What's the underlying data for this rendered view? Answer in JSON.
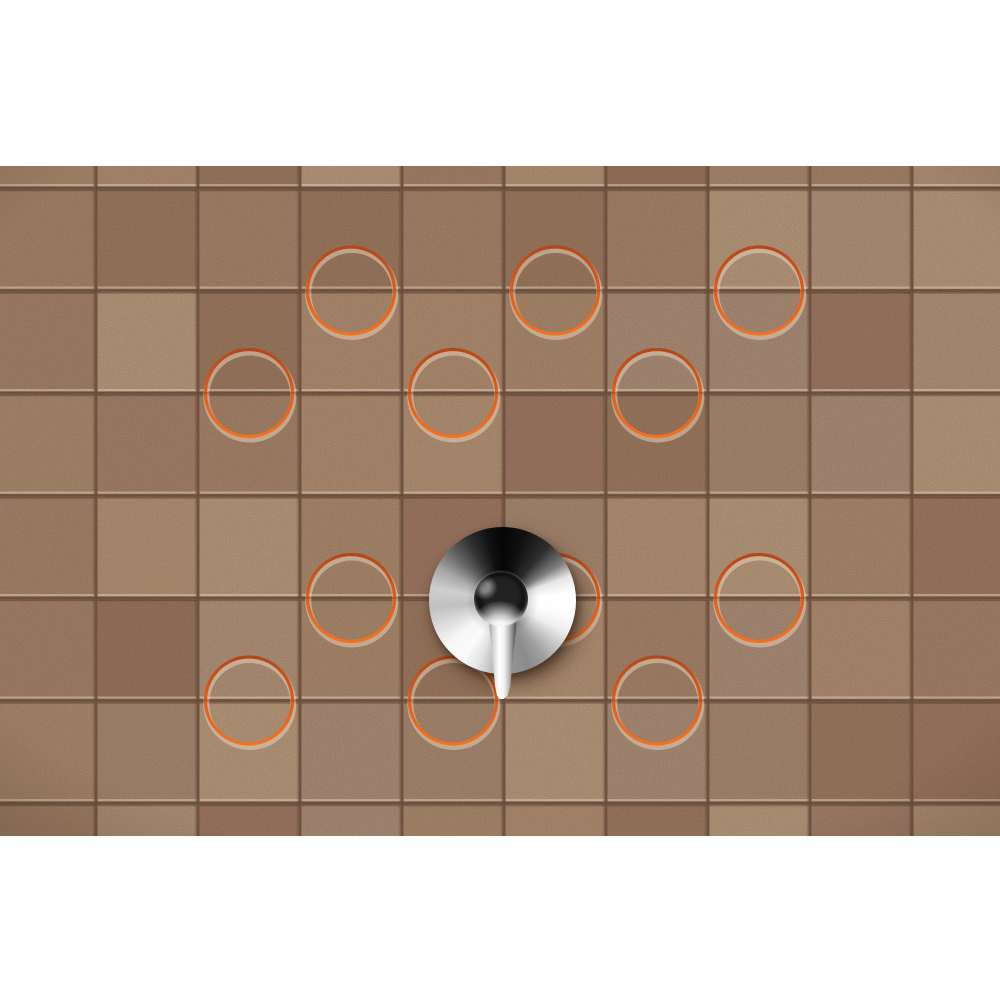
{
  "meta": {
    "alt": "Brown terracotta tile wall with embossed orange ring decors and a chrome single-lever shower mixer valve"
  },
  "canvas": {
    "width": 1000,
    "height": 1000,
    "background": "#ffffff"
  },
  "photo": {
    "x": 0,
    "y": 166,
    "width": 1000,
    "height": 670
  },
  "wall": {
    "grout_color": "#6d5342",
    "groove_core_color": "#4a2f1f",
    "bevel_highlight": "rgba(236,214,184,0.42)",
    "bevel_shadow": "rgba(40,24,14,0.33)",
    "tile_width": 102,
    "tile_height": 102.5,
    "origin_x": -6,
    "origin_y": -80.5,
    "columns": 10,
    "rows": 8,
    "tile_inset": 1.6,
    "palette": [
      "#8f7159",
      "#987860",
      "#846351",
      "#9c7e66",
      "#8b6c56",
      "#94745d",
      "#7f604d",
      "#907462",
      "#8a6a57",
      "#967863",
      "#82644f",
      "#8d705c"
    ],
    "noise_opacity": 0.42
  },
  "rings": {
    "radius": 43.5,
    "stroke_width": 3.2,
    "color_top": "#b3471a",
    "color_mid": "#dd5a1e",
    "color_bottom": "#f4711f",
    "highlight_color": "#ecd9bf",
    "highlight_width": 6,
    "highlight_opacity": 0.5,
    "positions": [
      {
        "x": 351,
        "y": 124.5
      },
      {
        "x": 555,
        "y": 124.5
      },
      {
        "x": 759,
        "y": 124.5
      },
      {
        "x": 249,
        "y": 227
      },
      {
        "x": 453,
        "y": 227
      },
      {
        "x": 657,
        "y": 227
      },
      {
        "x": 351,
        "y": 432
      },
      {
        "x": 555,
        "y": 432
      },
      {
        "x": 759,
        "y": 432
      },
      {
        "x": 249,
        "y": 534.5
      },
      {
        "x": 453,
        "y": 534.5
      },
      {
        "x": 657,
        "y": 534.5
      }
    ]
  },
  "fixture": {
    "escutcheon": {
      "cx": 502,
      "cy": 434.5,
      "radius": 73.5
    },
    "knob": {
      "cx": 501,
      "cy": 432.5,
      "radius": 27
    },
    "lever": {
      "left": 486.5,
      "top": 448,
      "width": 33,
      "height": 85
    },
    "chrome_dark": "#060606",
    "chrome_light": "#ffffff",
    "shadow_color": "rgba(35,18,8,0.5)"
  }
}
